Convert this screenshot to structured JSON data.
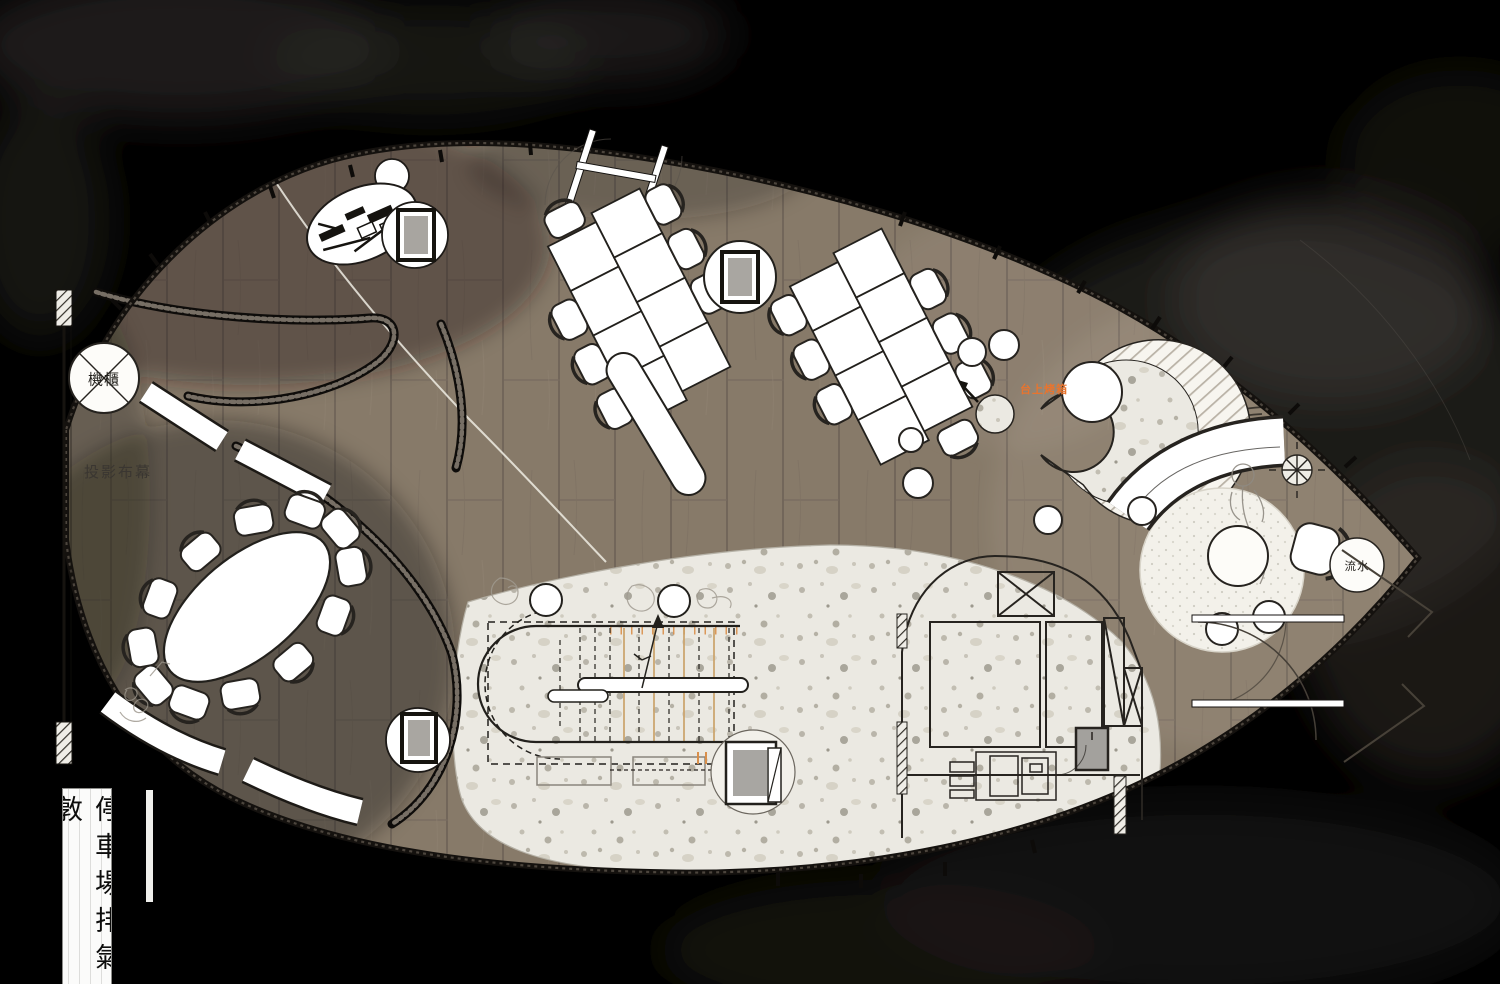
{
  "document": {
    "type": "interior floor plan",
    "style": "ink-wash presentation plan"
  },
  "labels": {
    "equipment_cabinet": "機櫃",
    "projection_screen": "投影布幕",
    "countertop_oven": "台上烤箱",
    "water_feature": "流水",
    "parking_exhaust_shaft": "停車場排氣敦"
  },
  "colors": {
    "background": "#000000",
    "ink_wash_cloud": "#37332d",
    "wood_floor": "#867968",
    "wood_floor_dark": "#5f574d",
    "terrazzo": "#ebe9e2",
    "furniture_fill": "#ffffff",
    "outline": "#26231f",
    "stair_tread_accent": "#d98f4a",
    "oven_label_color": "#e8742e"
  }
}
